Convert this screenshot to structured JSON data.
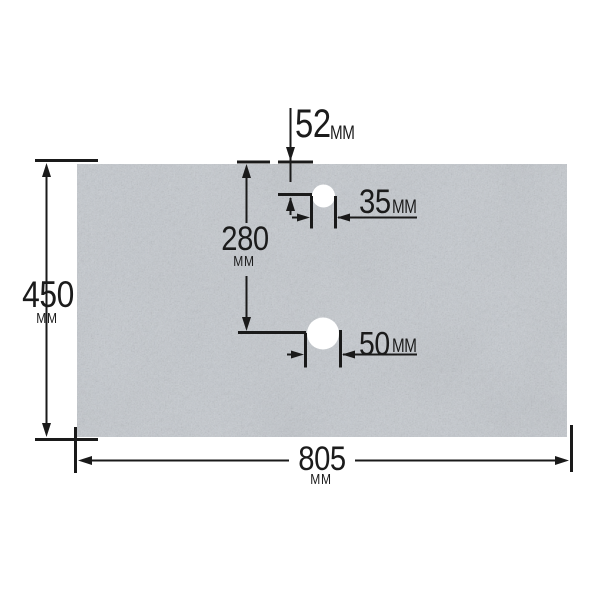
{
  "diagram": {
    "type": "technical-dimension-drawing",
    "subject": "stone worktop panel with two tap holes",
    "unit": "мм",
    "dims": {
      "height": {
        "value": "450",
        "unit": "мм"
      },
      "width": {
        "value": "805",
        "unit": "мм"
      },
      "hole1_offset": {
        "value": "52",
        "unit": "мм"
      },
      "hole1_width": {
        "value": "35",
        "unit": "мм"
      },
      "hole2_offset": {
        "value": "280",
        "unit": "мм"
      },
      "hole2_width": {
        "value": "50",
        "unit": "мм"
      }
    },
    "colors": {
      "background": "#ffffff",
      "line": "#1a1a1a",
      "slab_effective": "#a9aeb3",
      "hole": "#ffffff"
    }
  }
}
